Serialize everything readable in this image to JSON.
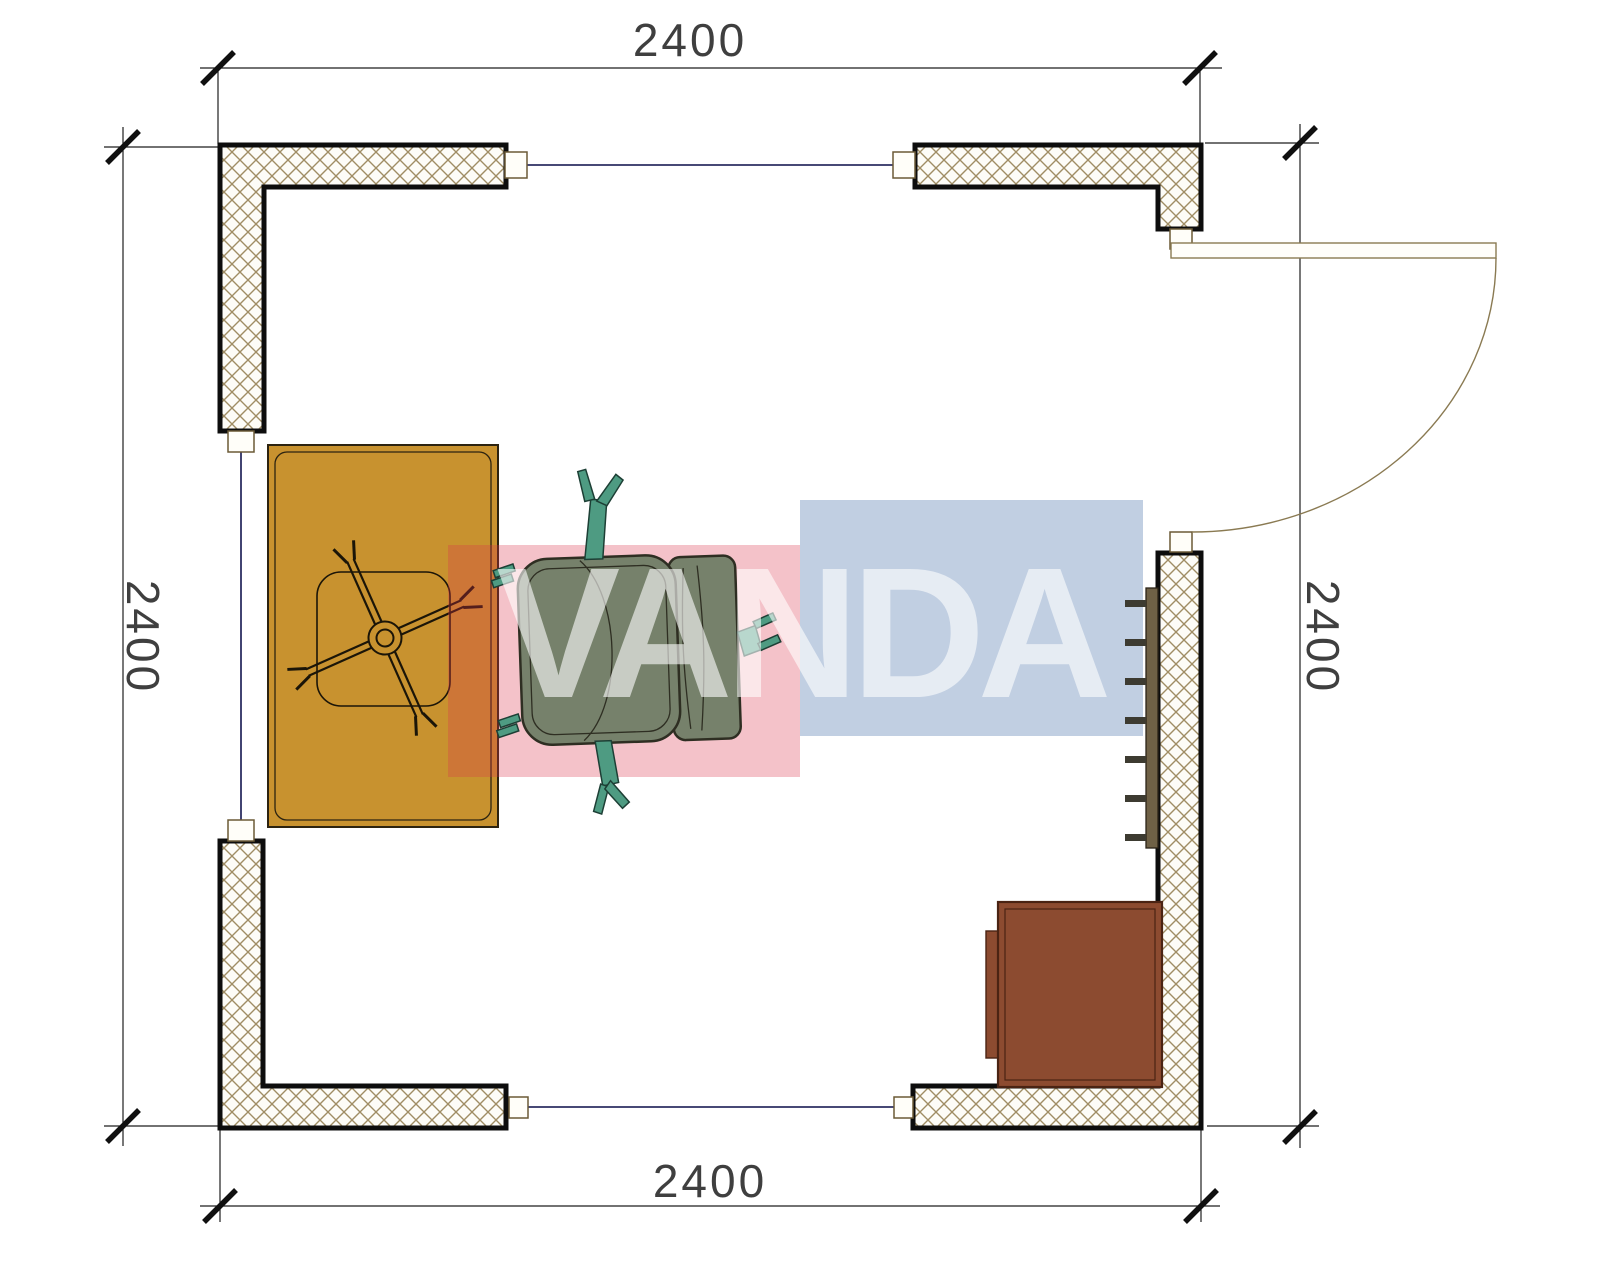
{
  "dimensions": {
    "top": "2400",
    "bottom": "2400",
    "left": "2400",
    "right": "2400"
  },
  "watermark": {
    "text": "VANDA",
    "red_block_color": "#DB364C",
    "blue_block_color": "#5C81B2",
    "text_color": "#FFFFFF"
  },
  "colors": {
    "wall_outline": "#0D0D0D",
    "wall_hatch": "#A08D64",
    "window_line": "#2D2F63",
    "door_line": "#8A7A52",
    "dimension_line": "#1F1F1F",
    "dimension_text": "#3F3F3F",
    "desk": "#C8922F",
    "chair_body": "#76816B",
    "chair_accent": "#4E9B82",
    "radiator_bar": "#6F6146",
    "radiator_tick": "#3D3B31",
    "cabinet": "#8C4B30"
  },
  "symbols": [
    "desk",
    "chair-star-base",
    "chair-mat",
    "office-chair",
    "radiator",
    "cabinet",
    "door-swing",
    "window"
  ]
}
